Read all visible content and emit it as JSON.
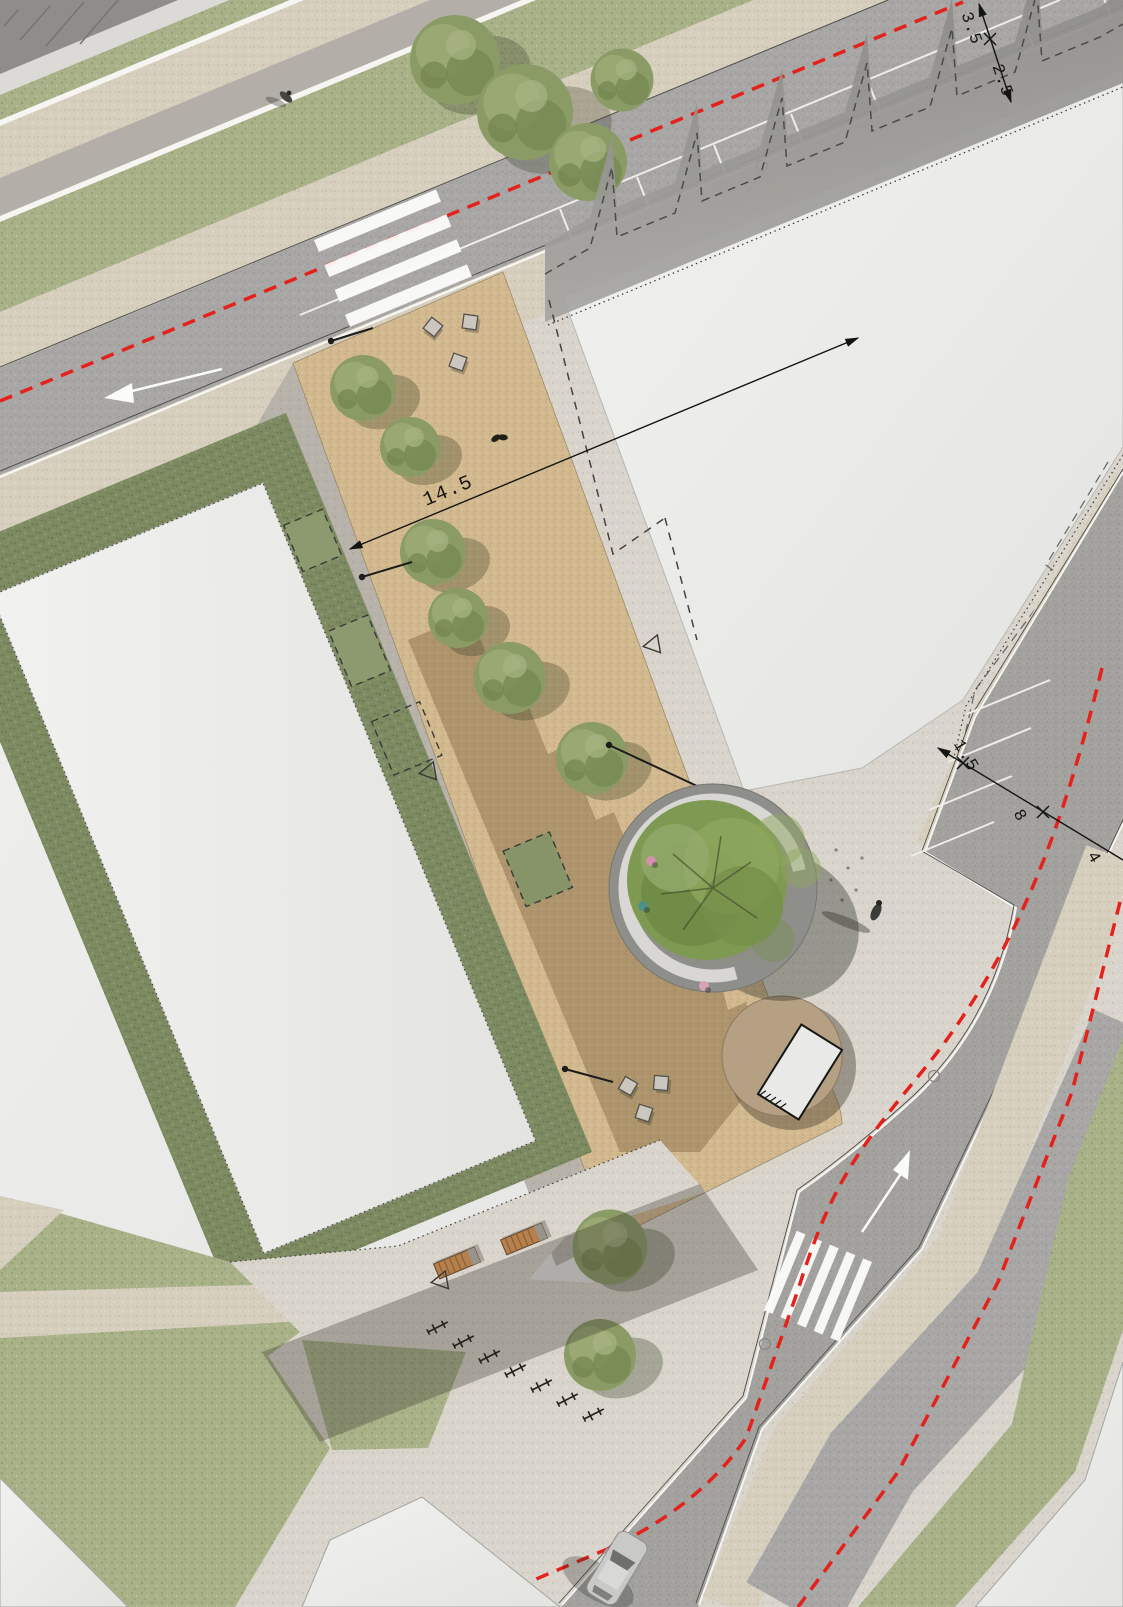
{
  "annotations": {
    "plaza_width": "14.5",
    "north_road": {
      "lane_width": "3.5",
      "parking_lane_width": "2.5"
    },
    "east_road": {
      "sidewalk_width": "1.5",
      "carriageway_width": "8",
      "parking_depth": "4"
    }
  },
  "colors": {
    "route_red": "#e4211b",
    "sand_plaza": "#d3b98f",
    "asphalt": "#a8a7a5",
    "concrete": "#d9d5cc",
    "grass": "#a9b189",
    "hedge": "#7e8b62",
    "building": "#ededeb",
    "bench_wood": "#b5804b"
  }
}
